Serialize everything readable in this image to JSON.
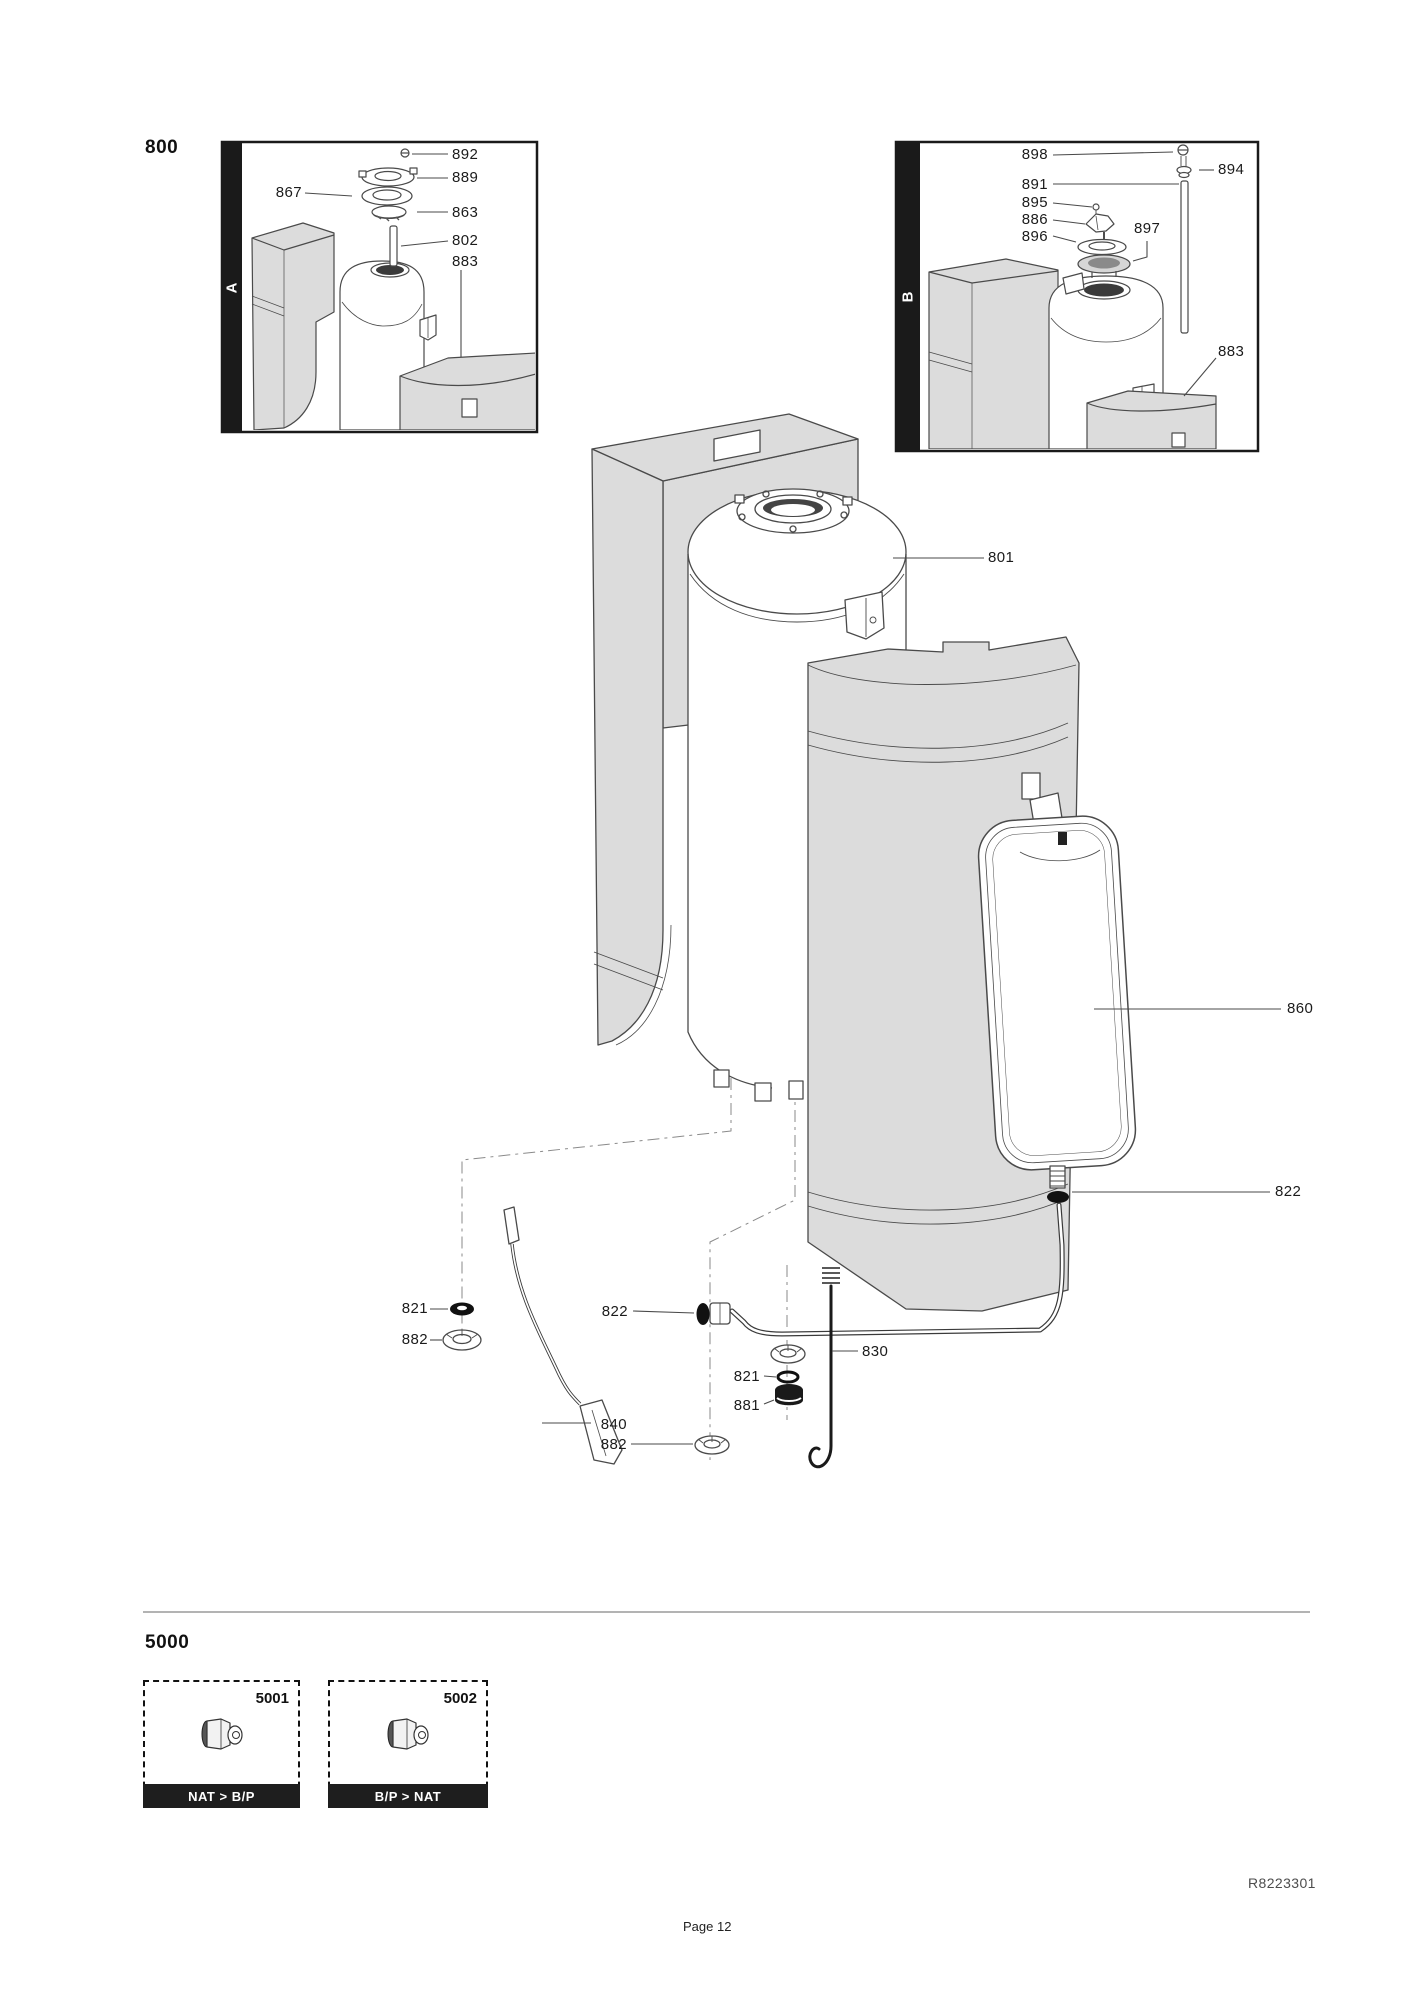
{
  "colors": {
    "shell_gray": "#dcdcdc",
    "outline": "#4a4a4a",
    "bar_black": "#1a1a1a",
    "leader_line": "#4a4a4a"
  },
  "section_800": {
    "title": "800",
    "inset_a": {
      "letter": "A",
      "parts": [
        "892",
        "889",
        "867",
        "863",
        "802",
        "883"
      ]
    },
    "inset_b": {
      "letter": "B",
      "parts": [
        "898",
        "894",
        "891",
        "895",
        "886",
        "896",
        "897",
        "883"
      ]
    },
    "main_parts": [
      "801",
      "860",
      "822",
      "821",
      "882",
      "822",
      "830",
      "821",
      "881",
      "840",
      "882"
    ]
  },
  "section_5000": {
    "title": "5000",
    "variants": [
      {
        "code": "5001",
        "caption": "NAT > B/P",
        "icon": "gas-injector"
      },
      {
        "code": "5002",
        "caption": "B/P > NAT",
        "icon": "gas-injector"
      }
    ]
  },
  "footer": {
    "doc_ref": "R8223301",
    "page_label": "Page 12"
  }
}
